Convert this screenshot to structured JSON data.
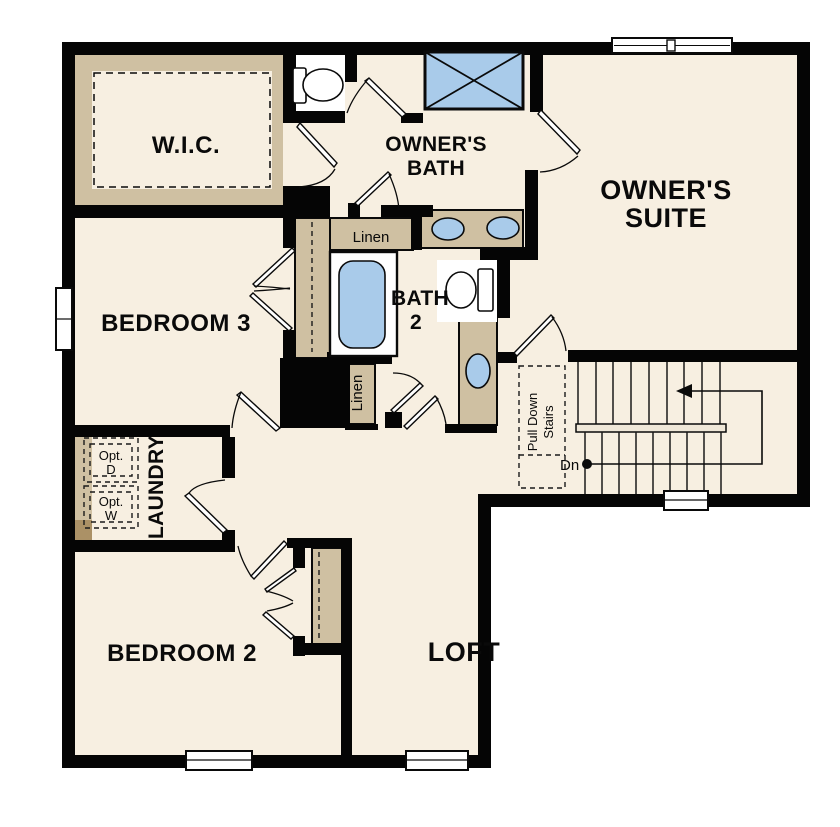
{
  "plan": {
    "title": "second-floor-plan",
    "labels": {
      "wic": "W.I.C.",
      "owners_bath_1": "OWNER'S",
      "owners_bath_2": "BATH",
      "owners_suite_1": "OWNER'S",
      "owners_suite_2": "SUITE",
      "bedroom3": "BEDROOM 3",
      "bath2_1": "BATH",
      "bath2_2": "2",
      "linen_upper": "Linen",
      "linen_lower": "Linen",
      "laundry": "LAUNDRY",
      "opt_d_1": "Opt.",
      "opt_d_2": "D",
      "opt_w_1": "Opt.",
      "opt_w_2": "W",
      "pull_down_1": "Pull Down",
      "pull_down_2": "Stairs",
      "down": "Dn",
      "bedroom2": "BEDROOM 2",
      "loft": "LOFT"
    },
    "colors": {
      "wall": "#050505",
      "floor": "#f7efe1",
      "counter": "#cfc0a2",
      "fixture_blue": "#a9cbea",
      "optional_gray": "#e4e4e4",
      "dark_tan": "#ab9166",
      "landing": "#efe7d8",
      "outside": "#ffffff"
    }
  }
}
